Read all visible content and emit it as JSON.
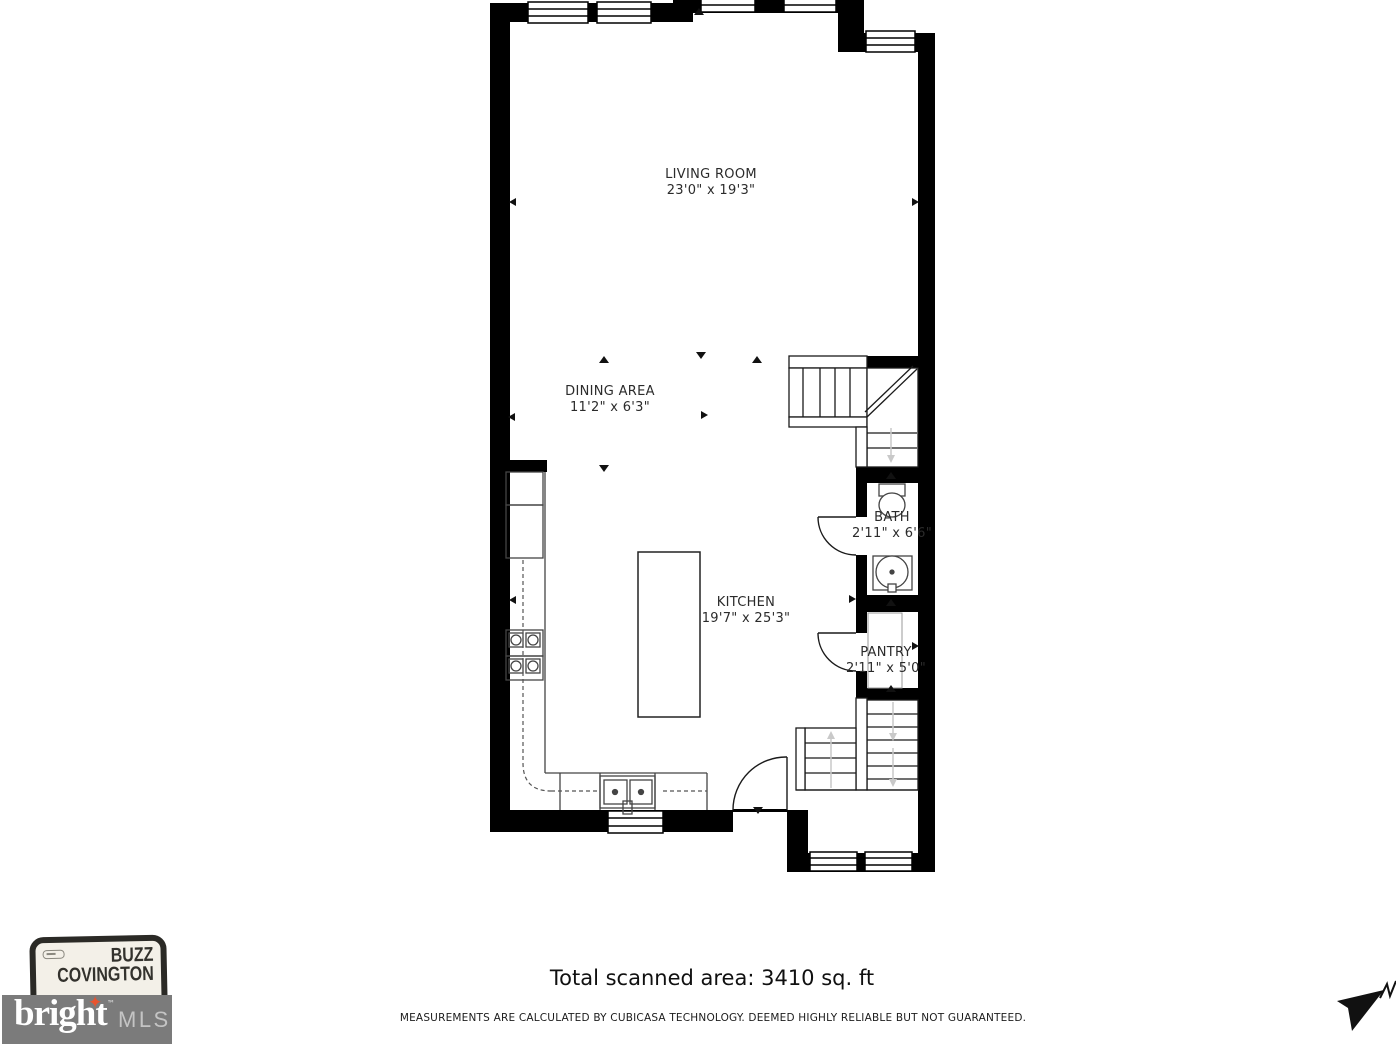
{
  "plan": {
    "rooms": [
      {
        "id": "living-room",
        "name": "LIVING ROOM",
        "dims": "23'0\" x 19'3\""
      },
      {
        "id": "dining-area",
        "name": "DINING AREA",
        "dims": "11'2\" x 6'3\""
      },
      {
        "id": "kitchen",
        "name": "KITCHEN",
        "dims": "19'7\" x 25'3\""
      },
      {
        "id": "bath",
        "name": "BATH",
        "dims": "2'11\" x 6'6\""
      },
      {
        "id": "pantry",
        "name": "PANTRY",
        "dims": "2'11\" x 5'0\""
      }
    ],
    "wall_color": "#000000"
  },
  "footer": {
    "total_area": "Total scanned area: 3410 sq. ft",
    "disclaimer": "MEASUREMENTS ARE CALCULATED BY CUBICASA TECHNOLOGY. DEEMED HIGHLY RELIABLE BUT NOT GUARANTEED."
  },
  "branding": {
    "agent_line1": "BUZZ",
    "agent_line2": "COVINGTON",
    "mls_name": "bright",
    "mls_tm": "™",
    "mls_suffix": "MLS",
    "star_color": "#e8542f",
    "box_color": "#7b7b7b"
  }
}
